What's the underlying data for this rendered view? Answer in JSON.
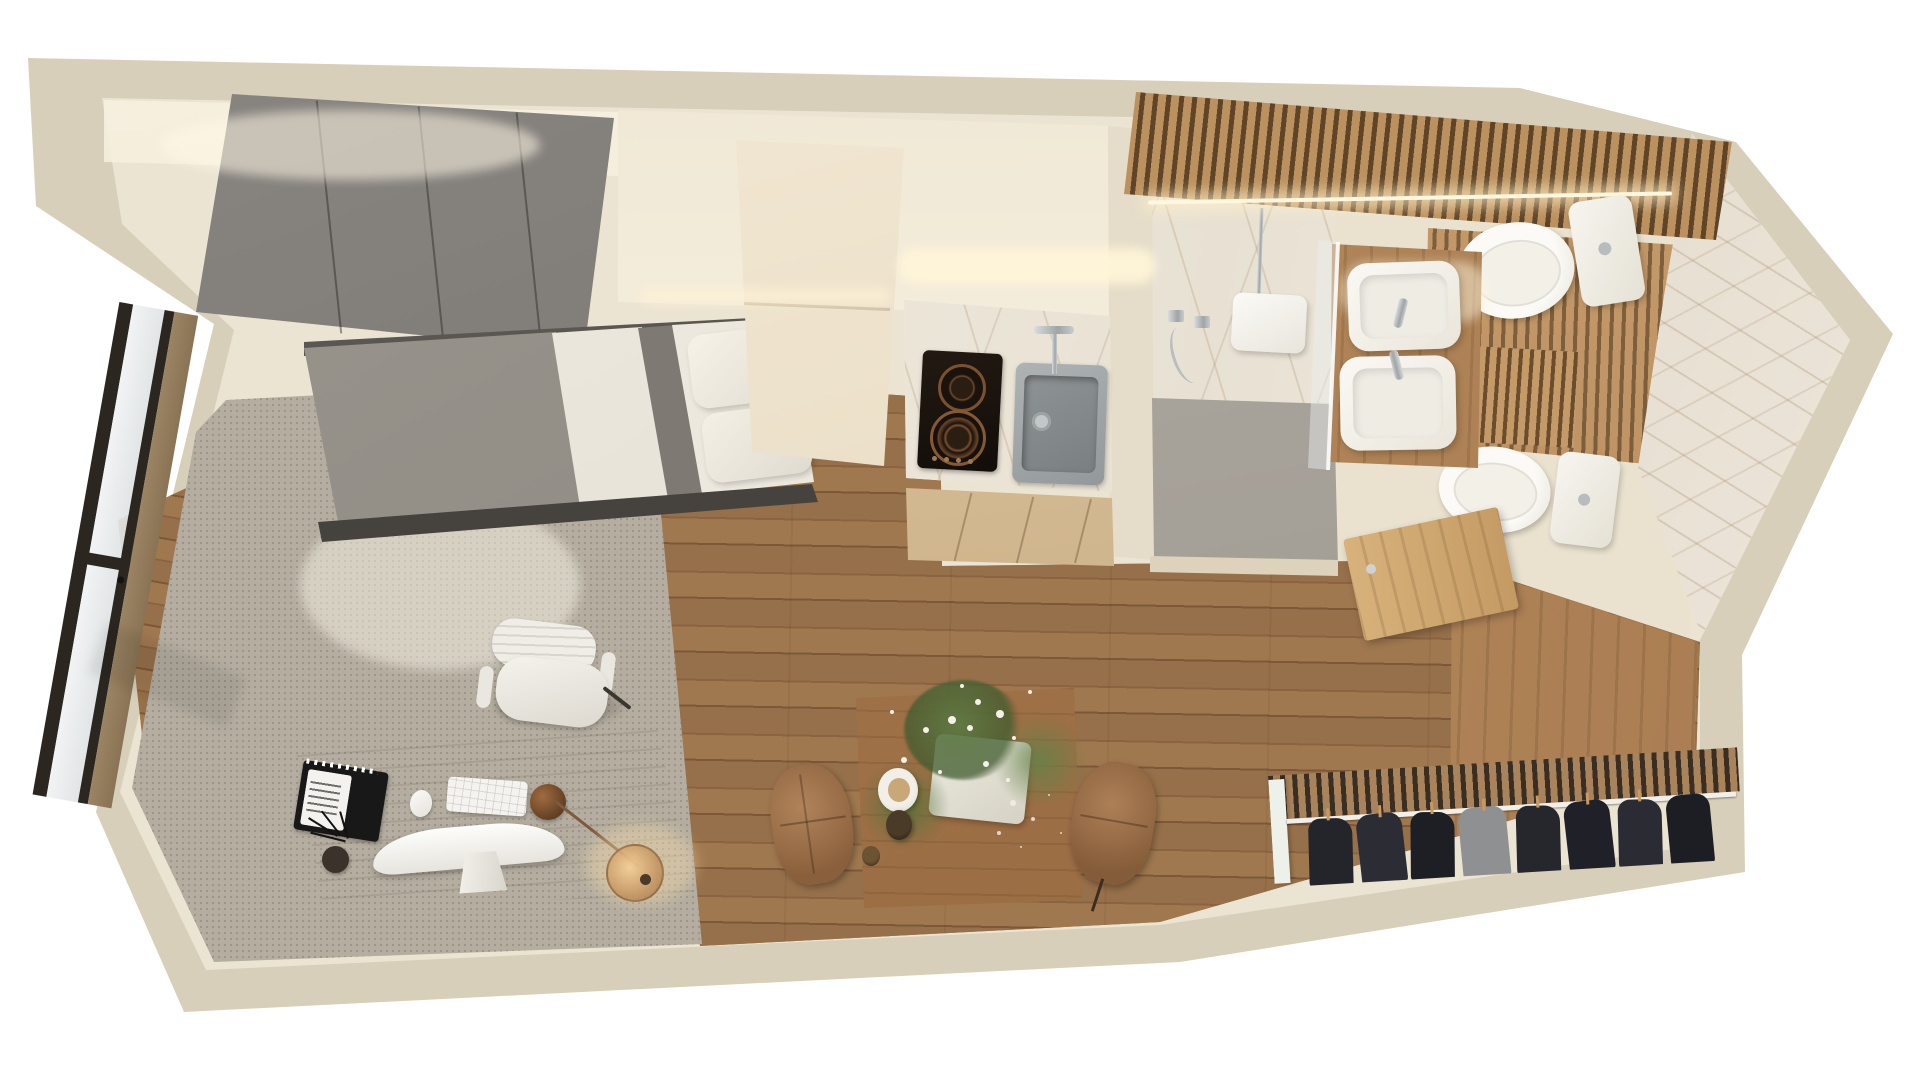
{
  "title": "Studio apartment 3D floor plan — top-down render",
  "palette": {
    "bg": "#ffffff",
    "wall-outer": "#d8cfba",
    "wall-inner": "#ece4d2",
    "wall-face": "#f2ead9",
    "glow": "#fff5dc",
    "rug": "#b4ada0",
    "wood-light": "#f0e6d2",
    "wood-mid": "#c9a26f",
    "wood-deep": "#a87c50",
    "desk-wood": "#b2926f",
    "wardrobe": "#7d7975",
    "bed-duvet": "#918d87",
    "bed-frame": "#46423e",
    "linen": "#e9e5db",
    "pillow": "#f3efe5",
    "white": "#f7f5ef",
    "marble-base": "#f2ede5",
    "gray-floor": "#a7a29a",
    "chrome1": "#c9cdce",
    "black-frame": "#2b2620",
    "brass": "#8a5c38",
    "brass-light": "#e4bb83",
    "chair-brown": "#a4774e",
    "clothes-dark": "#25262c",
    "clothes-gray": "#8f9092",
    "green": "#5d7a42",
    "flower": "#f4f1e8"
  },
  "scene": {
    "view": "top-down 3D cutaway render of a long studio apartment",
    "rooms": [
      {
        "name": "Sleeping area",
        "furniture": [
          "grey wardrobe",
          "single bed with grey duvet and white linen",
          "grey area rug",
          "wood desk",
          "white office chair",
          "brass desk lamp",
          "white computer",
          "keyboard",
          "mouse",
          "notebook",
          "pen cup"
        ]
      },
      {
        "name": "Kitchenette",
        "furniture": [
          "tall light-wood cabinet",
          "marble countertop",
          "black two-burner cooktop",
          "grey sink with chrome faucet",
          "wood base cabinets",
          "under-cabinet lighting"
        ]
      },
      {
        "name": "Dining nook",
        "furniture": [
          "wood dining table",
          "two brown chairs",
          "white planter with flowers",
          "coffee cups",
          "candle"
        ]
      },
      {
        "name": "Bathroom",
        "furniture": [
          "marble walk-in shower",
          "rain shower head",
          "hand shower",
          "glass partition",
          "double vessel-sink wood vanity",
          "two toilets",
          "wood slat ceiling with LED strip",
          "wood door"
        ]
      },
      {
        "name": "Entry nook",
        "furniture": [
          "open clothes rail with dark garments",
          "wood wall paneling"
        ]
      },
      {
        "name": "Balcony glazing",
        "furniture": [
          "black framed window wall"
        ]
      }
    ]
  }
}
